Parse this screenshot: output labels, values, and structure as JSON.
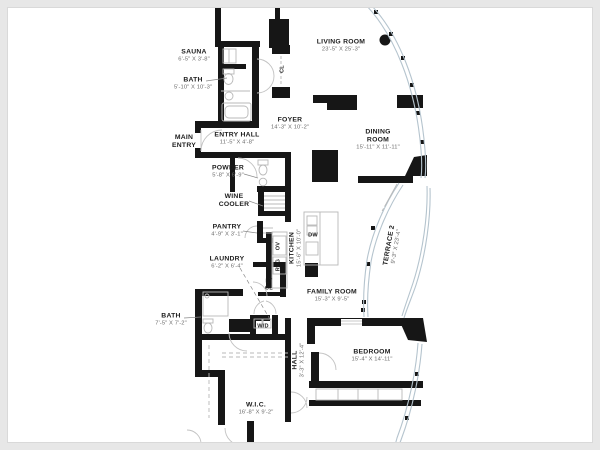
{
  "colors": {
    "wall": "#161616",
    "glass": "#b5c4ce",
    "fixture": "#b8b8b8"
  },
  "rooms": {
    "top_room": {
      "dims": "10'-0\" X 12'-8\""
    },
    "living_room": {
      "name": "LIVING ROOM",
      "dims": "23'-5\" X 25'-3\""
    },
    "sauna": {
      "name": "SAUNA",
      "dims": "6'-5\" X 3'-8\""
    },
    "bath_upper": {
      "name": "BATH",
      "dims": "5'-10\" X 10'-3\""
    },
    "main_entry": {
      "name": "MAIN ENTRY"
    },
    "entry_hall": {
      "name": "ENTRY HALL",
      "dims": "11'-5\" X 4'-8\""
    },
    "foyer": {
      "name": "FOYER",
      "dims": "14'-3\" X 10'-2\""
    },
    "cl": {
      "name": "CL"
    },
    "powder": {
      "name": "POWDER",
      "dims": "5'-8\" X 6'-9\""
    },
    "wine_cooler": {
      "name": "WINE COOLER"
    },
    "pantry": {
      "name": "PANTRY",
      "dims": "4'-9\" X 3'-1\""
    },
    "dining_room": {
      "name": "DINING ROOM",
      "dims": "15'-11\" X 11'-11\""
    },
    "kitchen": {
      "name": "KITCHEN",
      "dims": "15'-6\" X 10'-0\""
    },
    "ov": {
      "name": "OV"
    },
    "rfg": {
      "name": "RFG"
    },
    "dw": {
      "name": "DW"
    },
    "laundry": {
      "name": "LAUNDRY",
      "dims": "6'-2\" X 6'-4\""
    },
    "lt_cl": {
      "name": "LT CL"
    },
    "wd": {
      "name": "W/D"
    },
    "family_room": {
      "name": "FAMILY ROOM",
      "dims": "15'-3\" X 9'-5\""
    },
    "terrace2": {
      "name": "TERRACE 2",
      "dims": "9'-3\" X 23'-4\""
    },
    "bath_lower": {
      "name": "BATH",
      "dims": "7'-5\" X 7'-2\""
    },
    "hall": {
      "name": "HALL",
      "dims": "3'-3\" X 12'-4\""
    },
    "wic": {
      "name": "W.I.C.",
      "dims": "16'-8\" X 9'-2\""
    },
    "bedroom": {
      "name": "BEDROOM",
      "dims": "15'-4\" X 14'-11\""
    },
    "primary": {
      "name": "PRIMARY"
    }
  }
}
